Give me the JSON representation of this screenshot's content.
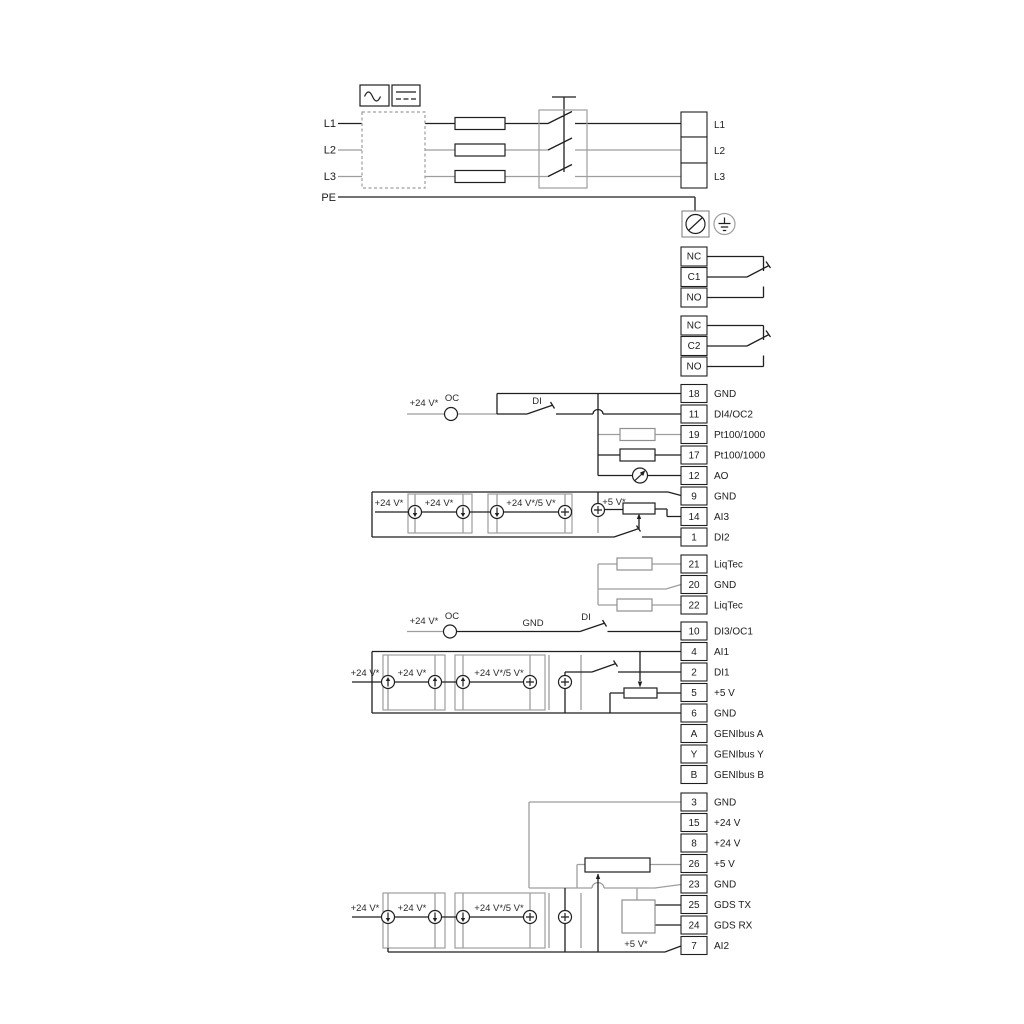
{
  "power": {
    "inputs": [
      "L1",
      "L2",
      "L3",
      "PE"
    ],
    "outputs": [
      "L1",
      "L2",
      "L3"
    ]
  },
  "relays": {
    "r1": [
      "NC",
      "C1",
      "NO"
    ],
    "r2": [
      "NC",
      "C2",
      "NO"
    ]
  },
  "io1": [
    [
      "18",
      "GND"
    ],
    [
      "11",
      "DI4/OC2"
    ],
    [
      "19",
      "Pt100/1000"
    ],
    [
      "17",
      "Pt100/1000"
    ],
    [
      "12",
      "AO"
    ],
    [
      "9",
      "GND"
    ],
    [
      "14",
      "AI3"
    ],
    [
      "1",
      "DI2"
    ]
  ],
  "io2": [
    [
      "21",
      "LiqTec"
    ],
    [
      "20",
      "GND"
    ],
    [
      "22",
      "LiqTec"
    ]
  ],
  "io3": [
    [
      "10",
      "DI3/OC1"
    ],
    [
      "4",
      "AI1"
    ],
    [
      "2",
      "DI1"
    ],
    [
      "5",
      "+5 V"
    ],
    [
      "6",
      "GND"
    ],
    [
      "A",
      "GENIbus A"
    ],
    [
      "Y",
      "GENIbus Y"
    ],
    [
      "B",
      "GENIbus B"
    ]
  ],
  "io4": [
    [
      "3",
      "GND"
    ],
    [
      "15",
      "+24 V"
    ],
    [
      "8",
      "+24 V"
    ],
    [
      "26",
      "+5 V"
    ],
    [
      "23",
      "GND"
    ],
    [
      "25",
      "GDS TX"
    ],
    [
      "24",
      "GDS RX"
    ],
    [
      "7",
      "AI2"
    ]
  ],
  "ann": {
    "p24": "+24 V*",
    "p24_5": "+24 V*/5 V*",
    "p5": "+5 V*",
    "oc": "OC",
    "di": "DI",
    "gnd": "GND"
  },
  "colors": {
    "wire_black": "#1f1f1f",
    "wire_gray": "#9e9e9e"
  }
}
